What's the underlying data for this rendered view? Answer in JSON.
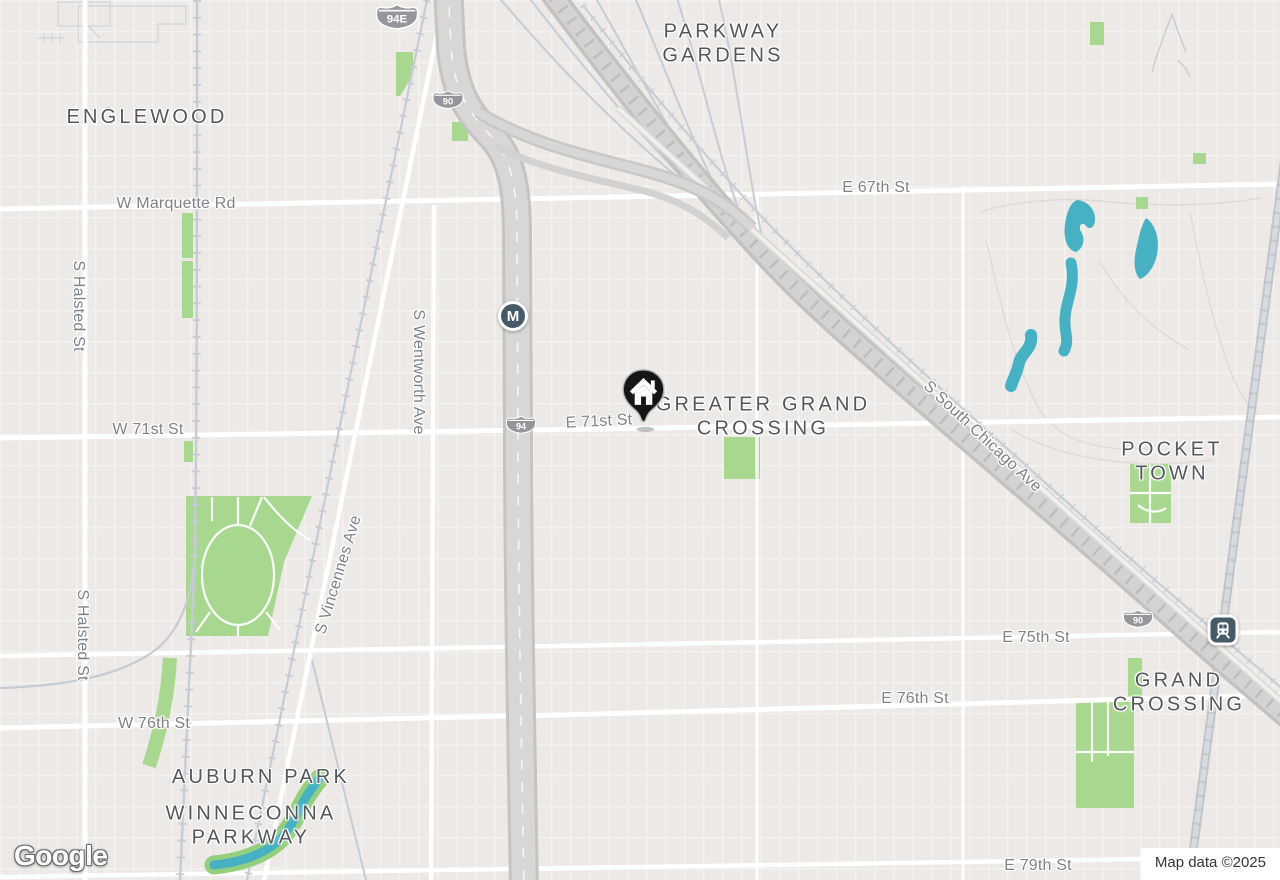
{
  "map": {
    "provider": "Google",
    "attribution": "Map data ©2025",
    "neighborhood_labels": [
      {
        "text": "ENGLEWOOD"
      },
      {
        "text": "PARKWAY\nGARDENS"
      },
      {
        "text": "GREATER GRAND\nCROSSING"
      },
      {
        "text": "POCKET TOWN"
      },
      {
        "text": "AUBURN PARK"
      },
      {
        "text": "WINNECONNA\nPARKWAY"
      },
      {
        "text": "GRAND\nCROSSING"
      }
    ],
    "street_labels": [
      {
        "text": "W Marquette Rd"
      },
      {
        "text": "E 67th St"
      },
      {
        "text": "S Halsted St"
      },
      {
        "text": "S Halsted St"
      },
      {
        "text": "W 71st St"
      },
      {
        "text": "E 71st St"
      },
      {
        "text": "S Wentworth Ave"
      },
      {
        "text": "S Vincennes Ave"
      },
      {
        "text": "S South Chicago Ave"
      },
      {
        "text": "E 75th St"
      },
      {
        "text": "E 76th St"
      },
      {
        "text": "W 76th St"
      },
      {
        "text": "E 79th St"
      }
    ],
    "route_shields": [
      {
        "text": "94E"
      },
      {
        "text": "90"
      },
      {
        "text": "94"
      },
      {
        "text": "90"
      }
    ],
    "transit": {
      "metro_glyph": "M",
      "rail_station_icon": "train-icon"
    },
    "marker": {
      "icon": "home-pin-icon",
      "color": "#151515"
    },
    "colors": {
      "background": "#ece9e6",
      "road": "#ffffff",
      "highway_fill": "#d8d7d5",
      "highway_casing": "#c5c4c2",
      "railway": "#c6cbd4",
      "park": "#a8d890",
      "water": "#47b1c4",
      "neighborhood_label": "#54585c",
      "street_label": "#7e8388",
      "shield_fill": "#94969a",
      "transit_icon_fill": "#475a68"
    }
  }
}
